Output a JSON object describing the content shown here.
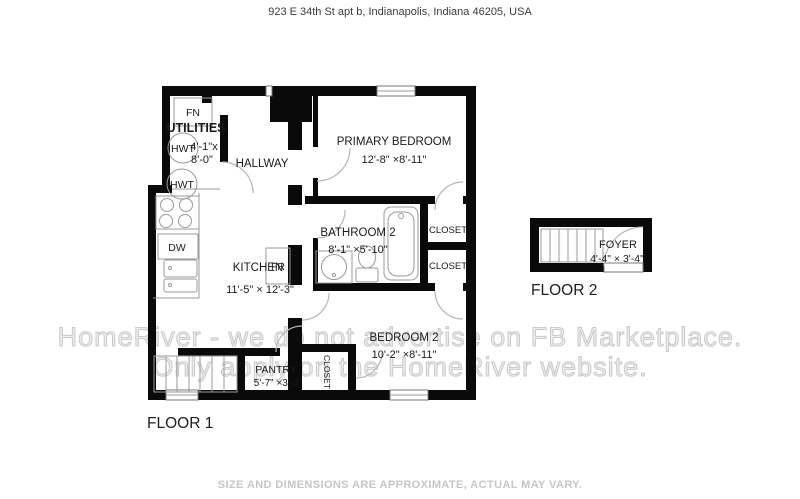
{
  "header": {
    "address": "923 E 34th St apt b, Indianapolis, Indiana 46205, USA"
  },
  "floor1": {
    "label": "FLOOR 1",
    "rooms": {
      "utilities": {
        "name": "UTILITIES",
        "dims1": "4'-1\"x",
        "dims2": "8'-0\""
      },
      "hallway": {
        "name": "HALLWAY"
      },
      "primary_bedroom": {
        "name": "PRIMARY BEDROOM",
        "dims": "12'-8\" ×8'-11\""
      },
      "bathroom2": {
        "name": "BATHROOM 2",
        "dims": "8'-1\" ×5'-10\""
      },
      "kitchen": {
        "name": "KITCHEN",
        "dims": "11'-5\" ×  12'-3\""
      },
      "closet_a": {
        "name": "CLOSET"
      },
      "closet_b": {
        "name": "CLOSET"
      },
      "closet_c": {
        "name": "CLOSET"
      },
      "bedroom2": {
        "name": "BEDROOM 2",
        "dims": "10'-2\" ×8'-11\""
      },
      "pantry": {
        "name": "PANTRY",
        "dims": "5'-7\"  ×3'-4\""
      }
    },
    "fixtures": {
      "fn": "FN",
      "hwt": "HWT",
      "dw": "DW",
      "fr": "FR"
    }
  },
  "floor2": {
    "label": "FLOOR 2",
    "rooms": {
      "foyer": {
        "name": "FOYER",
        "dims": "4'-4\"  × 3'-4\""
      }
    }
  },
  "watermark": {
    "line1": "HomeRiver - we do not advertise on FB Marketplace.",
    "line2": "Only apply on the HomeRiver website."
  },
  "footer": {
    "disclaimer": "SIZE AND DIMENSIONS ARE APPROXIMATE, ACTUAL MAY VARY."
  },
  "colors": {
    "wall": "#0a0a0a",
    "fixture_line": "#9a9a9a",
    "door_arc": "#b5b5b5",
    "label": "#1a1a1a",
    "watermark": "#c9c9c9",
    "footer_text": "#c6c6c6",
    "header_text": "#3c3c3c"
  }
}
